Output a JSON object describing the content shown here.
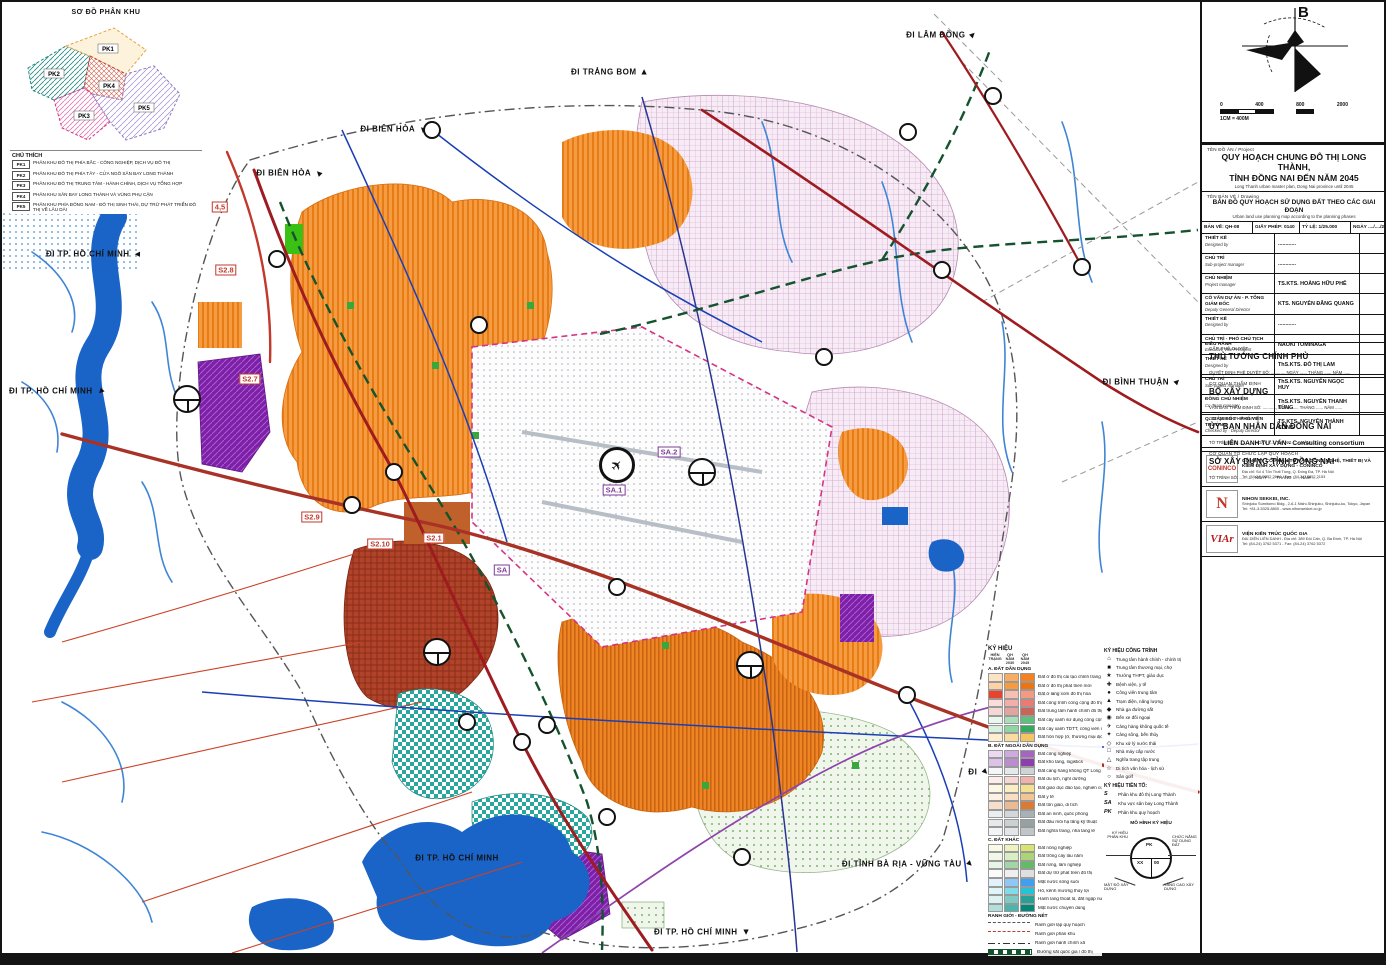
{
  "inset": {
    "title": "SƠ ĐỒ PHÂN KHU",
    "legend_title": "CHÚ THÍCH",
    "zones": [
      {
        "id": "PK1",
        "desc": "PHÂN KHU ĐÔ THỊ PHÍA BẮC - CÔNG NGHIỆP, DỊCH VỤ ĐÔ THỊ"
      },
      {
        "id": "PK2",
        "desc": "PHÂN KHU ĐÔ THỊ PHÍA TÂY - CỬA NGÕ SÂN BAY LONG THÀNH"
      },
      {
        "id": "PK3",
        "desc": "PHÂN KHU ĐÔ THỊ TRUNG TÂM - HÀNH CHÍNH, DỊCH VỤ TỔNG HỢP"
      },
      {
        "id": "PK4",
        "desc": "PHÂN KHU SÂN BAY LONG THÀNH VÀ VÙNG PHỤ CẬN"
      },
      {
        "id": "PK5",
        "desc": "PHÂN KHU PHÍA ĐÔNG NAM - ĐÔ THỊ SINH THÁI, DỰ TRỮ PHÁT TRIỂN ĐÔ THỊ VỀ LÂU DÀI"
      }
    ]
  },
  "compass": {
    "north": "B",
    "note": "1CM = 400M",
    "ticks": [
      "0",
      "400",
      "800",
      "2000"
    ]
  },
  "map": {
    "edge_labels": [
      {
        "text": "ĐI TRẢNG BOM",
        "x": 608,
        "y": 70,
        "rot": 0
      },
      {
        "text": "ĐI LÂM ĐỒNG",
        "x": 940,
        "y": 33,
        "rot": 45
      },
      {
        "text": "ĐI BIÊN HÒA",
        "x": 392,
        "y": 127,
        "rot": -45
      },
      {
        "text": "ĐI BIÊN HÒA",
        "x": 288,
        "y": 171,
        "rot": -45
      },
      {
        "text": "ĐI TP. HỒ CHÍ MINH",
        "x": 92,
        "y": 252,
        "rot": -90
      },
      {
        "text": "ĐI TP. HỒ CHÍ MINH",
        "x": 55,
        "y": 389,
        "rot": -135
      },
      {
        "text": "ĐI TP. HỒ CHÍ MINH",
        "x": 455,
        "y": 856,
        "rot": null
      },
      {
        "text": "ĐI TP. HỒ CHÍ MINH",
        "x": 700,
        "y": 930,
        "rot": 180
      },
      {
        "text": "ĐI TỈNH BÀ RỊA - VŨNG TÀU",
        "x": 906,
        "y": 862,
        "rot": 135
      },
      {
        "text": "ĐI BÌNH THUẬN",
        "x": 1140,
        "y": 380,
        "rot": 45
      },
      {
        "text": "ĐI",
        "x": 977,
        "y": 770,
        "rot": 135
      }
    ],
    "zone_labels": [
      {
        "text": "S2.8",
        "x": 224,
        "y": 268,
        "c": "r"
      },
      {
        "text": "S2.7",
        "x": 248,
        "y": 377,
        "c": "r"
      },
      {
        "text": "S2.9",
        "x": 310,
        "y": 515,
        "c": "r"
      },
      {
        "text": "S2.10",
        "x": 378,
        "y": 542,
        "c": "r"
      },
      {
        "text": "S2.1",
        "x": 432,
        "y": 536,
        "c": "r"
      },
      {
        "text": "SA",
        "x": 500,
        "y": 568,
        "c": "p"
      },
      {
        "text": "SA.1",
        "x": 612,
        "y": 488,
        "c": "p"
      },
      {
        "text": "SA.2",
        "x": 667,
        "y": 450,
        "c": "p"
      },
      {
        "text": "4,5",
        "x": 218,
        "y": 205,
        "c": "r"
      }
    ],
    "junctions": [
      [
        275,
        257
      ],
      [
        430,
        128
      ],
      [
        392,
        470
      ],
      [
        350,
        503
      ],
      [
        615,
        585
      ],
      [
        905,
        693
      ],
      [
        520,
        740
      ],
      [
        465,
        720
      ],
      [
        545,
        723
      ],
      [
        605,
        815
      ],
      [
        740,
        855
      ],
      [
        906,
        130
      ],
      [
        991,
        94
      ],
      [
        1080,
        265
      ],
      [
        822,
        355
      ],
      [
        940,
        268
      ],
      [
        477,
        323
      ]
    ],
    "prefix_circles": [
      [
        185,
        397
      ],
      [
        435,
        650
      ],
      [
        748,
        663
      ],
      [
        700,
        470
      ]
    ],
    "airport_circle": {
      "x": 615,
      "y": 463,
      "glyph": "✈"
    }
  },
  "legend": {
    "title": "KÝ HIỆU",
    "col_headers": [
      "HIỆN TRẠNG",
      "QH NĂM 2030",
      "QH NĂM 2045"
    ],
    "groups": [
      {
        "title": "A. ĐẤT DÂN DỤNG",
        "rows": [
          {
            "label": "Đất ở đô thị cải tạo chỉnh trang",
            "colors": [
              "#fce3c5",
              "#f8ad63",
              "#f5821f"
            ]
          },
          {
            "label": "Đất ở đô thị phát triển mới",
            "colors": [
              "#fdd2a7",
              "#f79a40",
              "#ee7410"
            ]
          },
          {
            "label": "Đất ở làng xóm đô thị hóa",
            "colors": [
              "#e8432d",
              "#f6c0b0",
              "#f29b82"
            ]
          },
          {
            "label": "Đất công trình công cộng đô thị",
            "colors": [
              "#fbdcda",
              "#f4aeaa",
              "#ea7a72"
            ]
          },
          {
            "label": "Đất trung tâm hành chính đô thị",
            "colors": [
              "#f3d8d6",
              "#e2a59e",
              "#c9645a"
            ]
          },
          {
            "label": "Đất cây xanh sử dụng công cộng",
            "colors": [
              "#e9f7ee",
              "#a8dfba",
              "#5bc27e"
            ]
          },
          {
            "label": "Đất cây xanh TDTT, công viên chuyên đề",
            "colors": [
              "#d8f1df",
              "#8fd6a4",
              "#37a85f"
            ]
          },
          {
            "label": "Đất hỗn hợp (ở, thương mại dịch vụ)",
            "colors": [
              "#fdeed2",
              "#fadc9f",
              "#f6c561"
            ]
          }
        ]
      },
      {
        "title": "B. ĐẤT NGOÀI DÂN DỤNG",
        "rows": [
          {
            "label": "Đất công nghiệp",
            "colors": [
              "#ead9f0",
              "#cfaade",
              "#a566c0"
            ]
          },
          {
            "label": "Đất kho tàng, logistics",
            "colors": [
              "#dcc2e6",
              "#bb8cce",
              "#8d3fad"
            ]
          },
          {
            "label": "Đất cảng hàng không QT Long Thành",
            "colors": [
              "#f5f6f7",
              "#e6e9ea",
              "#ced3d4"
            ]
          },
          {
            "label": "Đất du lịch, nghỉ dưỡng",
            "colors": [
              "#fdeeec",
              "#f9d7d3",
              "#f2b2aa"
            ]
          },
          {
            "label": "Đất giáo dục đào tạo, nghiên cứu",
            "colors": [
              "#fdf8e4",
              "#f9efc2",
              "#f3e18f"
            ]
          },
          {
            "label": "Đất y tế",
            "colors": [
              "#fdf1e6",
              "#f8dfc4",
              "#f2c694"
            ]
          },
          {
            "label": "Đất tôn giáo, di tích",
            "colors": [
              "#f6decb",
              "#ecba92",
              "#da7a35"
            ]
          },
          {
            "label": "Đất an ninh, quốc phòng",
            "colors": [
              "#ebedee",
              "#d3d7da",
              "#a8b2b6"
            ]
          },
          {
            "label": "Đất đầu mối hạ tầng kỹ thuật",
            "colors": [
              "#e6e8ea",
              "#cbd1d2",
              "#96a1a3"
            ]
          },
          {
            "label": "Đất nghĩa trang, nhà tang lễ",
            "colors": [
              "#f3f4f5",
              "#e3e6e8",
              "#bfc6c9"
            ]
          }
        ]
      },
      {
        "title": "C. ĐẤT KHÁC",
        "rows": [
          {
            "label": "Đất nông nghiệp",
            "colors": [
              "#f9fbe6",
              "#eef3bd",
              "#d9e370"
            ]
          },
          {
            "label": "Đất trồng cây lâu năm",
            "colors": [
              "#f2f8e8",
              "#daedc4",
              "#abd478"
            ]
          },
          {
            "label": "Đất rừng, lâm nghiệp",
            "colors": [
              "#e7f4e8",
              "#a3d6a6",
              "#63ba67"
            ]
          },
          {
            "label": "Đất dự trữ phát triển đô thị",
            "colors": [
              "#fbfbfb",
              "#efefef",
              "#dfdfdf"
            ]
          },
          {
            "label": "Mặt nước sông suối",
            "colors": [
              "#e2f1fc",
              "#8ec8f6",
              "#3f9ff0"
            ]
          },
          {
            "label": "Hồ, kênh mương thủy lợi",
            "colors": [
              "#def6f9",
              "#7fdce8",
              "#25c3d8"
            ]
          },
          {
            "label": "Hành lang thoát lũ, đất ngập nước",
            "colors": [
              "#dff2f0",
              "#7fcac2",
              "#27a096"
            ]
          },
          {
            "label": "Mặt nước chuyên dùng",
            "colors": [
              "#b2dfdb",
              "#4db6ac",
              "#00897b"
            ]
          }
        ]
      }
    ],
    "line_rows_title": "RANH GIỚI - ĐƯỜNG NÉT",
    "line_rows": [
      {
        "label": "Ranh giới lập quy hoạch",
        "style": "ls-dash-gray"
      },
      {
        "label": "Ranh giới phân khu",
        "style": "ls-dash-red"
      },
      {
        "label": "Ranh giới hành chính xã",
        "style": "ls-dashdot"
      },
      {
        "label": "Đường sắt quốc gia / đô thị",
        "style": "ls-rail"
      }
    ],
    "symbols_title": "KÝ HIỆU CÔNG TRÌNH",
    "symbols": [
      {
        "glyph": "⌂",
        "label": "Trung tâm hành chính - chính trị"
      },
      {
        "glyph": "■",
        "label": "Trung tâm thương mại, chợ"
      },
      {
        "glyph": "★",
        "label": "Trường THPT, giáo dục"
      },
      {
        "glyph": "✚",
        "label": "Bệnh viện, y tế"
      },
      {
        "glyph": "●",
        "label": "Công viên trung tâm"
      },
      {
        "glyph": "▲",
        "label": "Trạm điện, năng lượng"
      },
      {
        "glyph": "◆",
        "label": "Nhà ga đường sắt"
      },
      {
        "glyph": "◉",
        "label": "Bến xe đối ngoại"
      },
      {
        "glyph": "✈",
        "label": "Cảng hàng không quốc tế"
      },
      {
        "glyph": "✦",
        "label": "Cảng sông, bến thủy"
      },
      {
        "glyph": "◇",
        "label": "Khu xử lý nước thải"
      },
      {
        "glyph": "□",
        "label": "Nhà máy cấp nước"
      },
      {
        "glyph": "△",
        "label": "Nghĩa trang tập trung"
      },
      {
        "glyph": "☆",
        "label": "Di tích văn hóa - lịch sử"
      },
      {
        "glyph": "○",
        "label": "Sân golf"
      }
    ],
    "prefix_title": "KÝ HIỆU TIỀN TỐ:",
    "prefix": [
      {
        "sym": "S",
        "label": "Phân khu đô thị Long Thành"
      },
      {
        "sym": "SA",
        "label": "Khu vực sân bay Long Thành"
      },
      {
        "sym": "PK",
        "label": "Phân khu quy hoạch"
      }
    ],
    "diagram": {
      "title": "MÔ HÌNH KÝ HIỆU",
      "center_top": "PK",
      "center_left": "XX",
      "center_right": "00",
      "left": "KÝ HIỆU PHÂN KHU",
      "right": "CHỨC NĂNG SỬ DỤNG ĐẤT",
      "bottom_left": "MẬT ĐỘ XÂY DỰNG",
      "bottom_right": "TẦNG CAO XÂY DỰNG"
    }
  },
  "title_block": {
    "sections": [
      {
        "label": "CẤP PHÊ DUYỆT",
        "value": "THỦ TƯỚNG CHÍNH PHỦ",
        "note": "QUYẾT ĐỊNH PHÊ DUYỆT SỐ: ..........., NGÀY ...... THÁNG ...... NĂM ......"
      },
      {
        "label": "CƠ QUAN THẨM ĐỊNH",
        "value": "BỘ XÂY DỰNG",
        "note": "VĂN BẢN THẨM ĐỊNH SỐ: ..........., NGÀY ...... THÁNG ...... NĂM ......"
      },
      {
        "label": "CƠ QUAN PHÊ DUYỆT",
        "value": "ỦY BAN NHÂN DÂN ĐỒNG NAI",
        "note": "TỜ TRÌNH SỐ: ..........., NGÀY ...... THÁNG ...... NĂM ......"
      },
      {
        "label": "CƠ QUAN TỔ CHỨC LẬP QUY HOẠCH",
        "value": "SỞ XÂY DỰNG TỈNH ĐỒNG NAI",
        "note": "TỜ TRÌNH SỐ: ..........., NGÀY ...... THÁNG ...... NĂM ......"
      }
    ],
    "project_label": "TÊN ĐỒ ÁN / Project",
    "project_title_line1": "QUY HOẠCH CHUNG ĐÔ THỊ LONG THÀNH,",
    "project_title_line2": "TỈNH ĐỒNG NAI ĐẾN NĂM 2045",
    "project_title_en": "Long Thanh urban master plan, Dong Nai province until 2045",
    "drawing_label": "TÊN BẢN VẼ / Drawing",
    "drawing_title": "BẢN ĐỒ QUY HOẠCH SỬ DỤNG ĐẤT THEO CÁC GIAI ĐOẠN",
    "drawing_title_en": "Urban land use planning map according to the planning phases",
    "info_row": {
      "sheet": "BẢN VẼ: QH-08",
      "permit": "GIẤY PHÉP: 0140",
      "scale": "TỶ LỆ: 1/25.000",
      "date": "NGÀY ..../..../202..."
    },
    "staff": [
      {
        "role": "THIẾT KẾ",
        "en": "Designed by",
        "name": "............"
      },
      {
        "role": "CHỦ TRÌ",
        "en": "Sub-project manager",
        "name": "............"
      },
      {
        "role": "CHỦ NHIỆM",
        "en": "Project manager",
        "name": "TS.KTS. HOÀNG HỮU PHÊ"
      },
      {
        "role": "CỐ VẤN DỰ ÁN - P. TỔNG GIÁM ĐỐC",
        "en": "Deputy General Director",
        "name": "KTS. NGUYỄN ĐĂNG QUANG"
      },
      {
        "role": "THIẾT KẾ",
        "en": "Designed by",
        "name": "............"
      },
      {
        "role": "CHỦ TRÌ - PHÓ CHỦ TỊCH ĐIỀU HÀNH",
        "en": "Executive Vice President",
        "name": "NAOKI TOMINAGA"
      },
      {
        "role": "THIẾT KẾ",
        "en": "Designed by",
        "name": "ThS.KTS. ĐỖ THỊ LAM"
      },
      {
        "role": "CHỦ TRÌ",
        "en": "Sub-project manager",
        "name": "ThS.KTS. NGUYỄN NGỌC HUY"
      },
      {
        "role": "ĐỒNG CHỦ NHIỆM",
        "en": "Co-Team manager",
        "name": "ThS.KTS. NGUYỄN THANH TÙNG"
      },
      {
        "role": "Q. GIÁM ĐỐC - PHÓ VIỆN TRƯỞNG",
        "en": "Checked by - Deputy Director",
        "name": "TS.KTS. NGUYỄN THÀNH CÔNG"
      }
    ],
    "consortium": "LIÊN DANH TƯ VẤN - Consulting consortium",
    "companies": [
      {
        "logo": "CONINCO",
        "name": "CÔNG TY CỔ PHẦN TƯ VẤN CÔNG NGHỆ, THIẾT BỊ VÀ KIỂM ĐỊNH XÂY DỰNG - CONINCO",
        "addr": "Địa chỉ: Số 4 Tôn Thất Tùng, Q. Đống Đa, TP. Hà Nội",
        "tel": "Tel: (84-24) 3852 2684 - Fax: (84-24) 3852 2153"
      },
      {
        "logo": "N",
        "name": "NIHON SEKKEI, INC.",
        "addr": "Shinjuku Sumitomo Bldg., 2-6-1 Nishi-Shinjuku, Shinjuku-ku, Tokyo, Japan",
        "tel": "Tel: +81-3-5325-8800 - www.nihonsekkei.co.jp"
      },
      {
        "logo": "VIAr",
        "name": "VIỆN KIẾN TRÚC QUỐC GIA",
        "addr": "ĐẠI DIỆN LIÊN DANH - Địa chỉ: 389 Đội Cấn, Q. Ba Đình, TP. Hà Nội",
        "tel": "Tel: (84-24) 3762 5371 - Fax: (84-24) 3762 5372"
      }
    ]
  }
}
